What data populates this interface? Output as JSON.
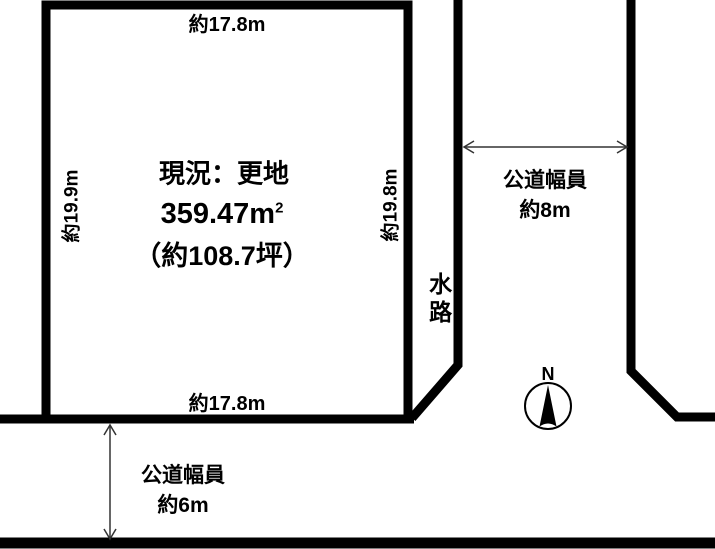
{
  "diagram": {
    "plot": {
      "status": "現況：更地",
      "area_value": "359.47",
      "area_unit_base": "m",
      "area_unit_exponent": "2",
      "area_tsubo": "（約108.7坪）",
      "width_top": "約17.8m",
      "width_bottom": "約17.8m",
      "depth_left": "約19.9m",
      "depth_right": "約19.8m"
    },
    "waterway_label": "水路",
    "east_road": {
      "label_line1": "公道幅員",
      "label_line2": "約8m"
    },
    "south_road": {
      "label_line1": "公道幅員",
      "label_line2": "約6m"
    },
    "compass_label": "N",
    "colors": {
      "line": "#000000",
      "arrow": "#333333",
      "background": "#ffffff"
    }
  }
}
